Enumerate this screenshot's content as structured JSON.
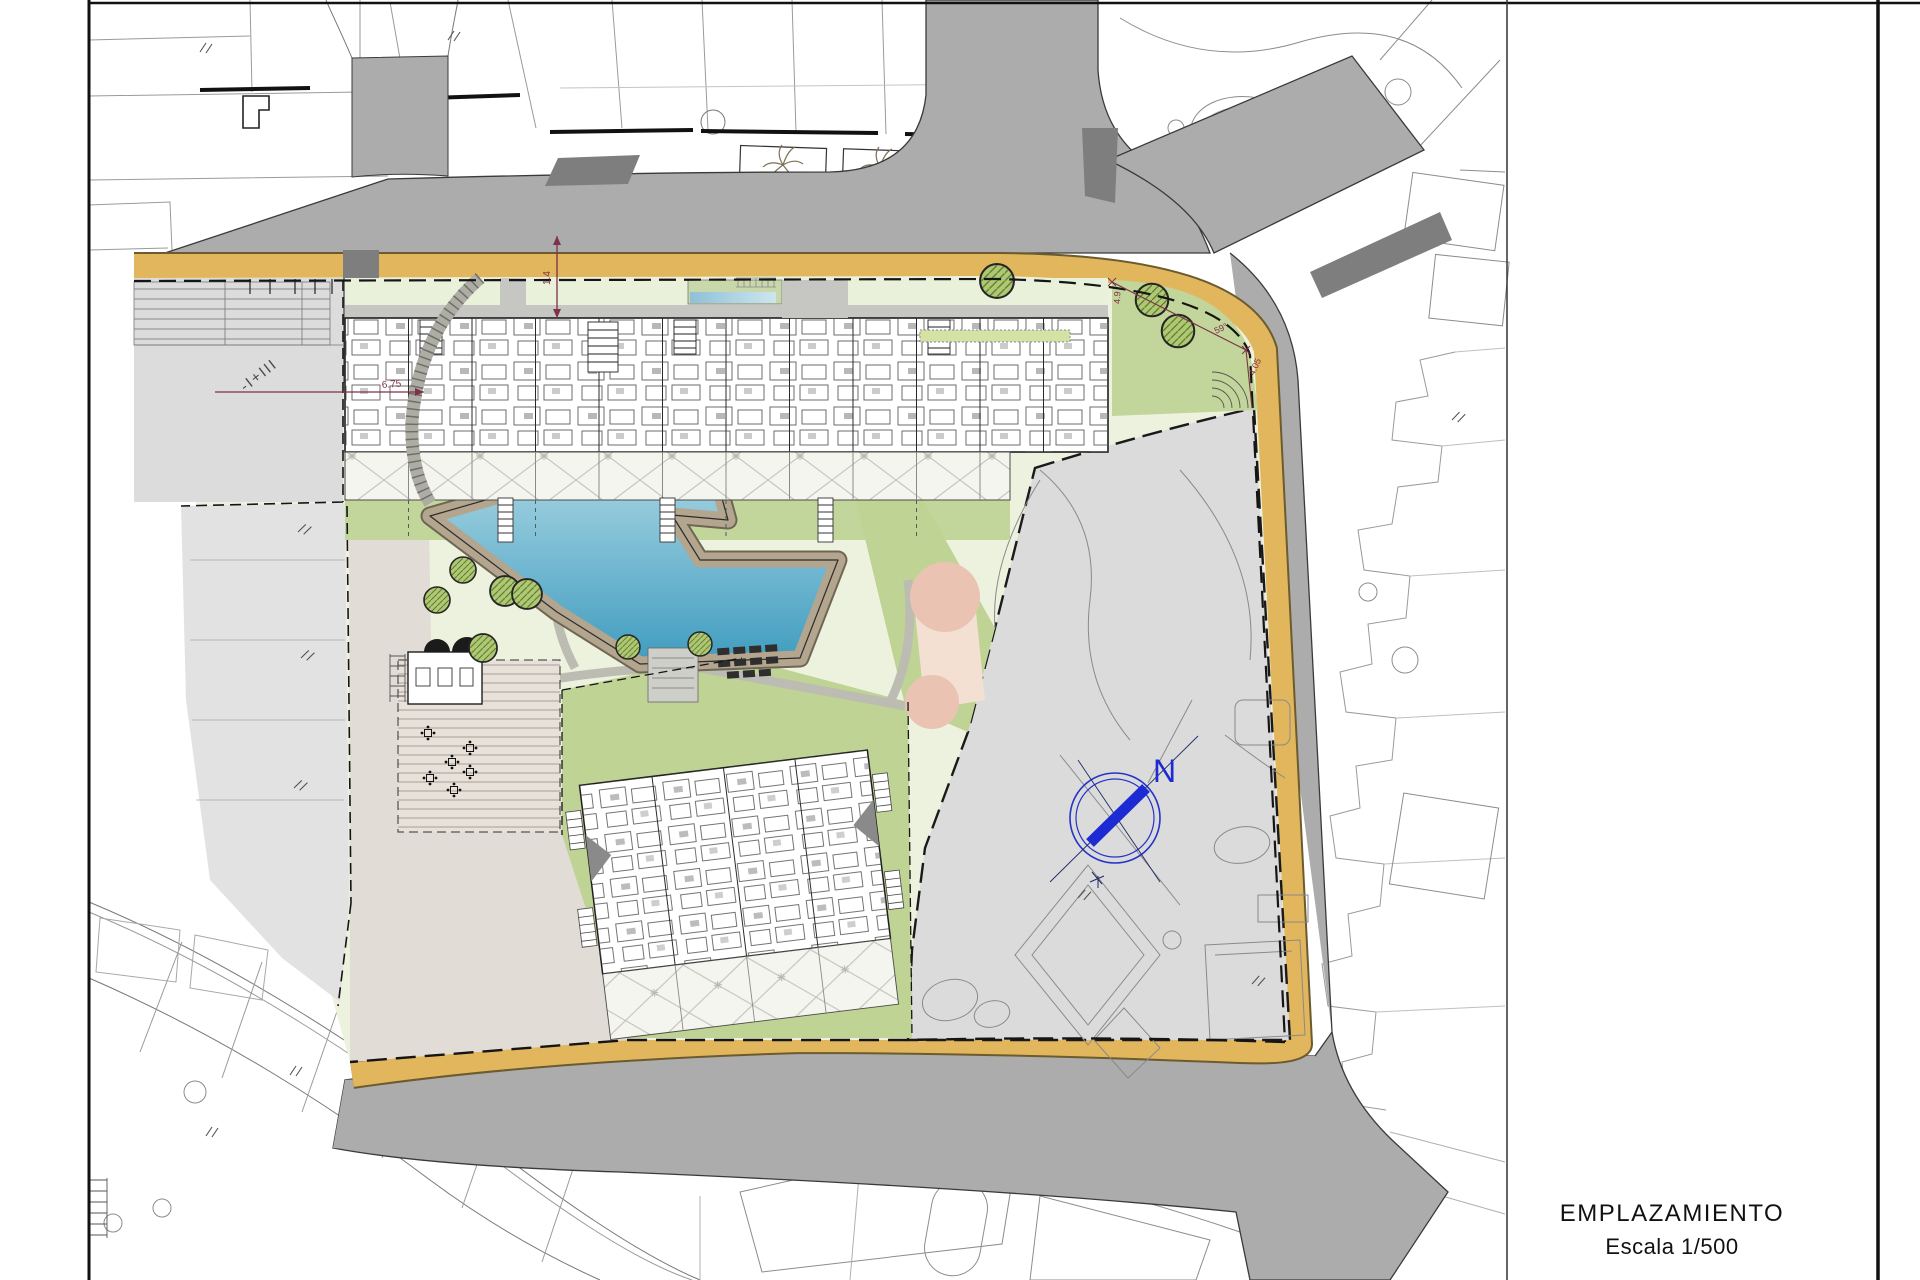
{
  "sheet": {
    "title": "EMPLAZAMIENTO",
    "scale": "Escala 1/500"
  },
  "compass": {
    "north_label": "N",
    "color": "#1c2bd0"
  },
  "annotations": {
    "left_parcel_label": "-I+III",
    "dim_width": "6.75",
    "dim_setback": "1.4",
    "dim_corner": "4.05",
    "angle_corner": "59°",
    "dim_east": "4.9"
  },
  "icons": {
    "compass": "north-compass",
    "palm": "palm-tree",
    "tree": "round-tree",
    "table": "table-and-chairs",
    "slope_tick": "double-tick"
  },
  "colors": {
    "road_gray": "#acacac",
    "dark_gray": "#7e7e7e",
    "sidewalk_orange": "#e2b65c",
    "site_green": "#edf2de",
    "garden_green": "#c2d59a",
    "tree_green": "#a9c36b",
    "pool_blue": "#4f9fc0",
    "deck_tan": "#b3a58e",
    "pink_circle": "#ebc3b3",
    "parcel_gray": "#dcdcdc",
    "compass_blue": "#1c2bd0",
    "dimension_red": "#7e3148"
  }
}
